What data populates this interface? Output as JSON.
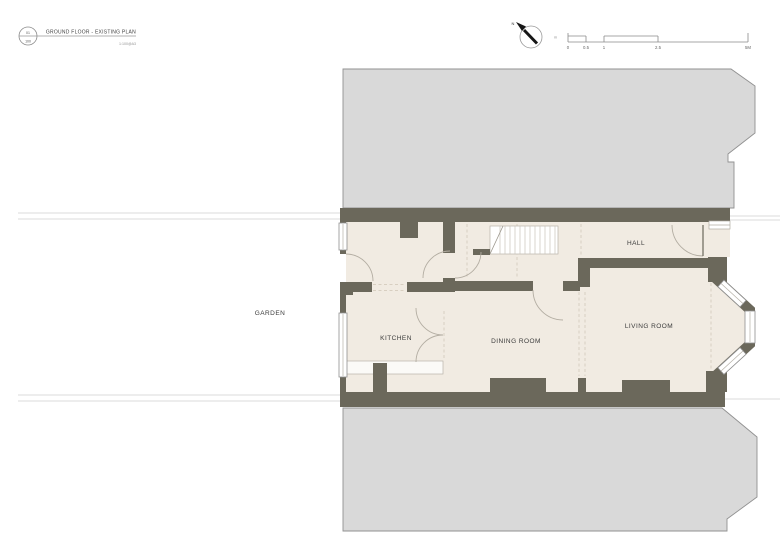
{
  "title_block": {
    "drawing_number": "01",
    "sheet_number": "100",
    "title": "GROUND FLOOR - EXISTING PLAN",
    "scale_note": "1:100@A3"
  },
  "north": {
    "label": "N"
  },
  "scale_bar": {
    "unit_label": "m",
    "ticks": [
      "0",
      "0.5",
      "1",
      "2.5",
      "5M"
    ]
  },
  "rooms": {
    "garden": "GARDEN",
    "kitchen": "KITCHEN",
    "dining": "DINING ROOM",
    "living": "LIVING ROOM",
    "hall": "HALL"
  },
  "colors": {
    "wall": "#6b685b",
    "neighbor_fill": "#d9d9d9",
    "neighbor_outline": "#919191",
    "floor": "#f1ebe2",
    "dashed_line": "#d8cfc1",
    "door_swing": "#b3ada2"
  }
}
